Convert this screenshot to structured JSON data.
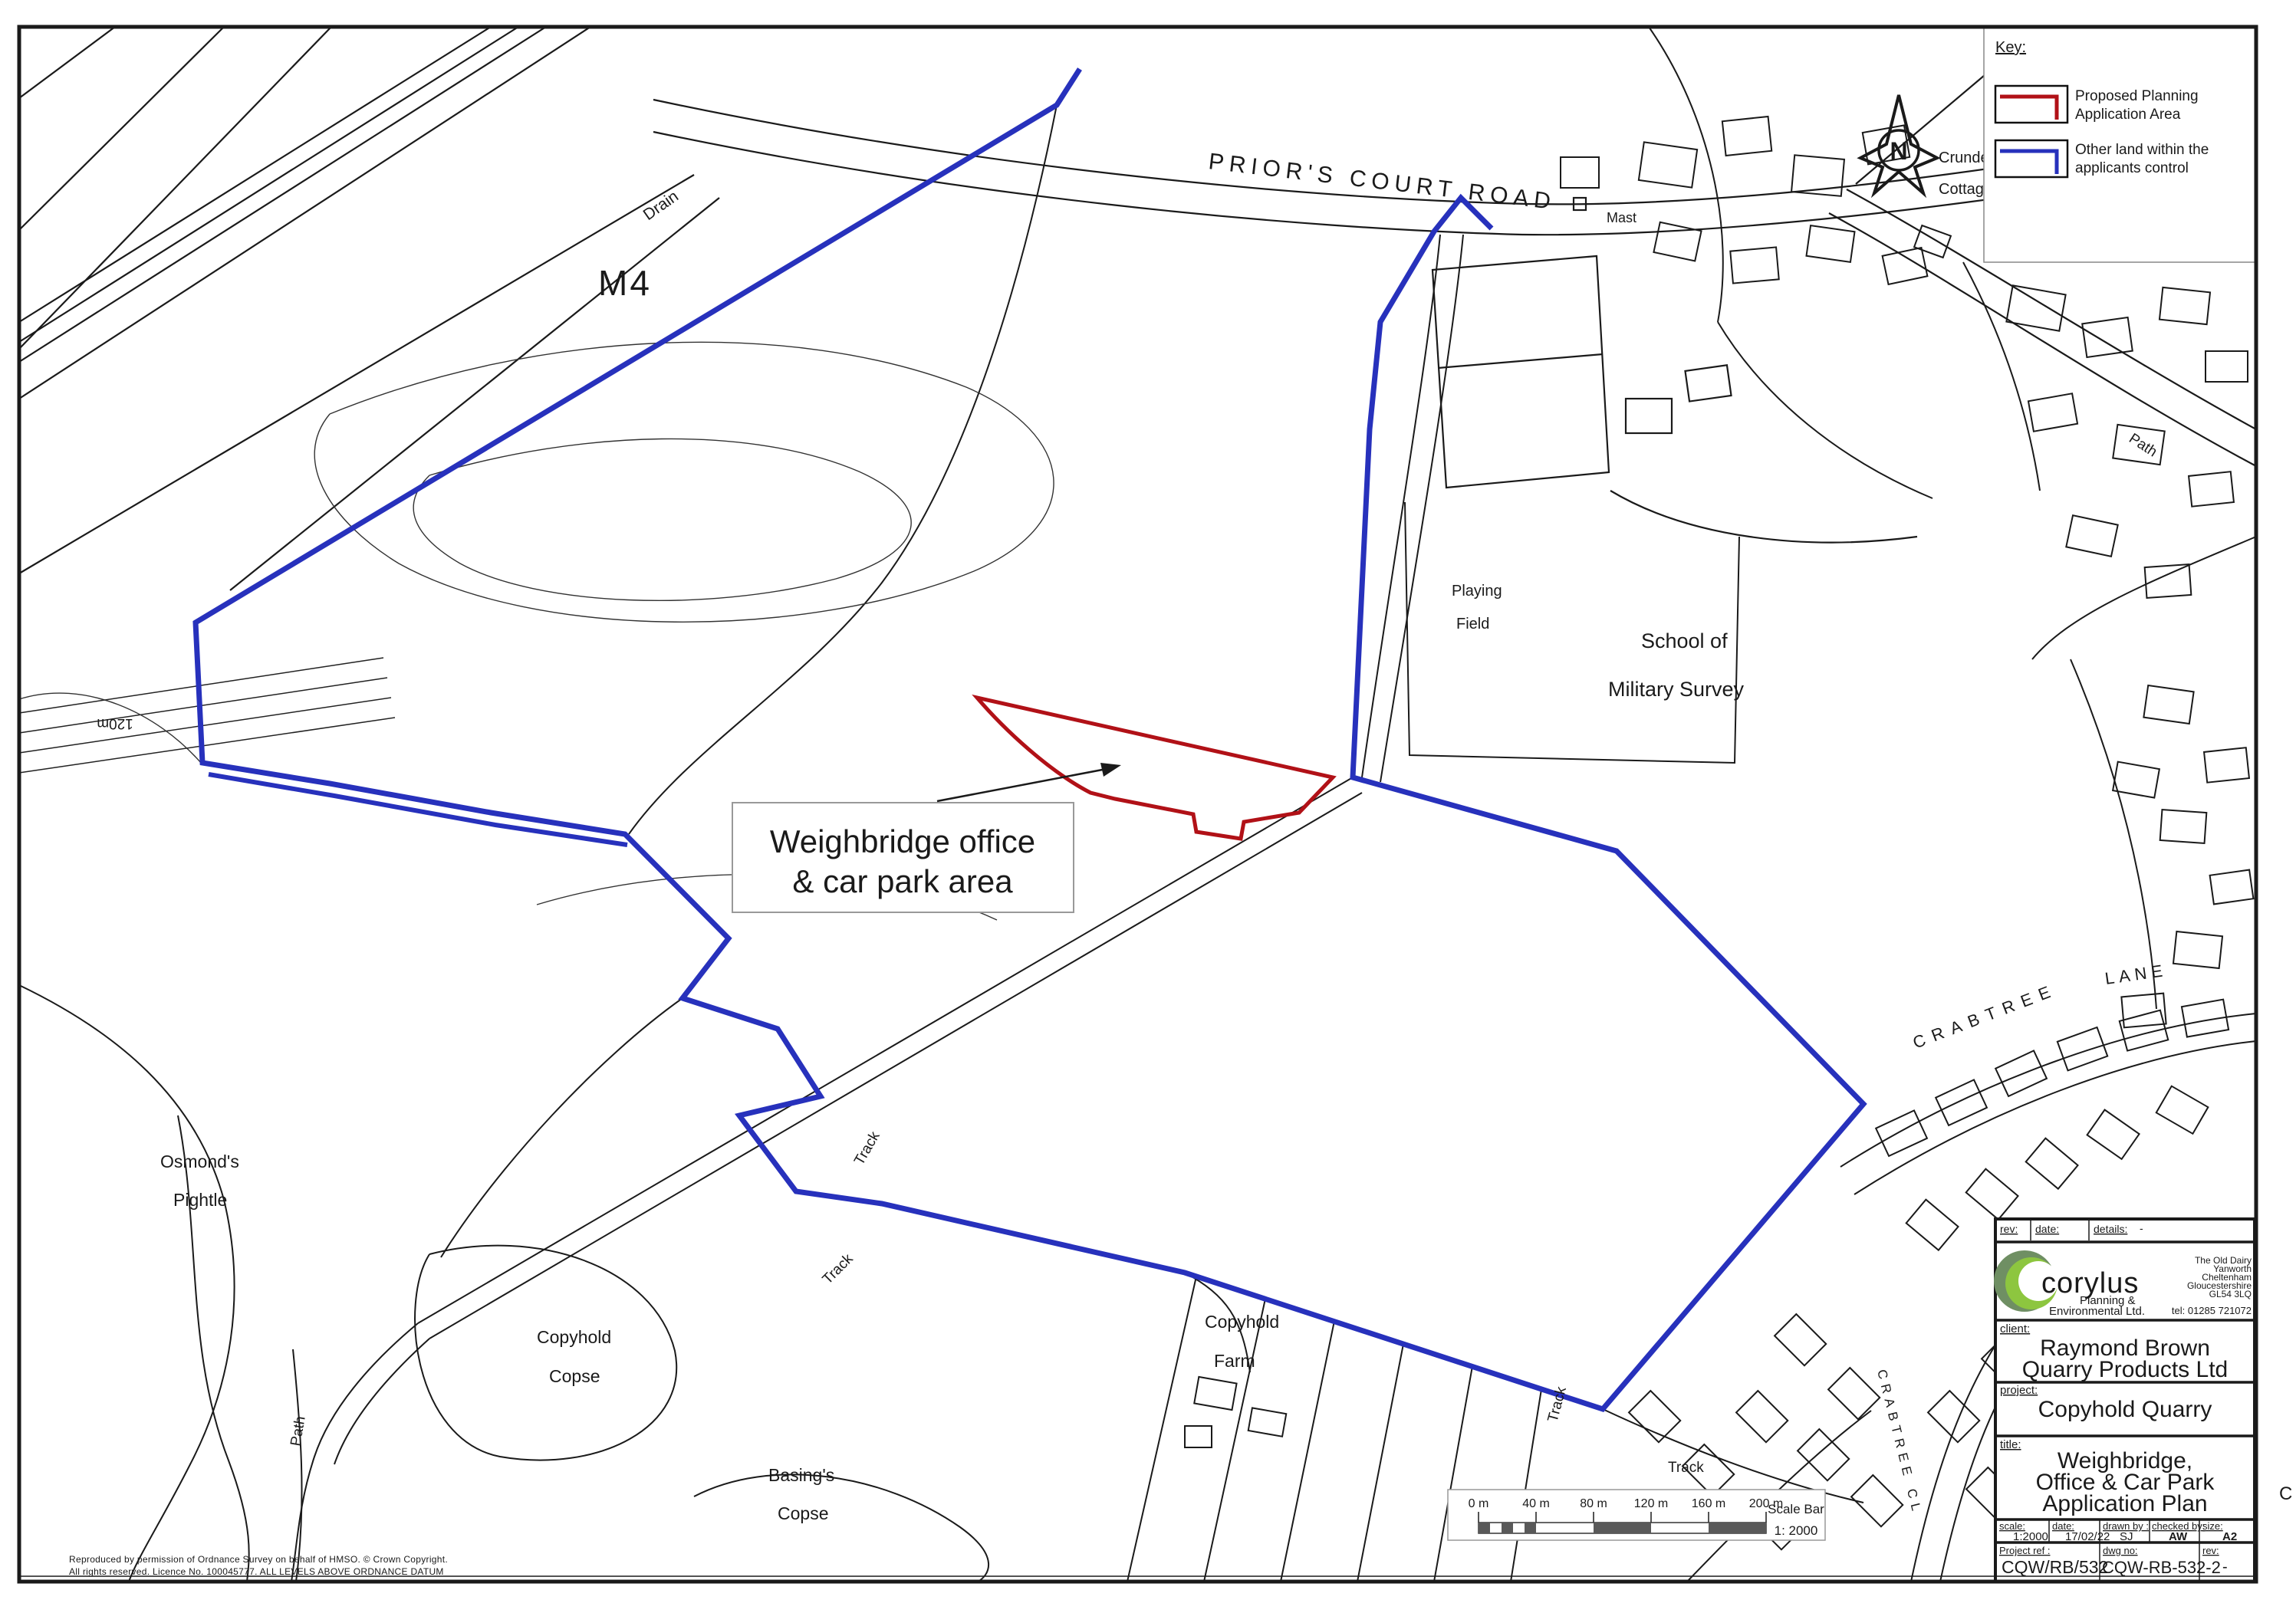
{
  "colors": {
    "application_red": "#B11117",
    "control_blue": "#2731BC",
    "bar_dark": "#595959",
    "line_black": "#1a1a1a"
  },
  "map_labels": {
    "m4": "M4",
    "priors_court_road": "PRIOR'S COURT ROAD",
    "drain": "Drain",
    "mast": "Mast",
    "crundel": "Crundel",
    "cottage": "Cottage",
    "path_ne": "Path",
    "playing": "Playing",
    "field": "Field",
    "school_of": "School of",
    "military_survey": "Military Survey",
    "crabtree": "CRABTREE",
    "lane": "LANE",
    "crabtree_cl": "CRABTREE CL",
    "cl": "CL",
    "osmonds": "Osmond's",
    "pightle": "Pightle",
    "copyhold_w": "Copyhold",
    "copse_w": "Copse",
    "basings": "Basing's",
    "copse_s": "Copse",
    "copyhold_farm": "Copyhold",
    "farm": "Farm",
    "path_sw": "Path",
    "track_1": "Track",
    "track_2": "Track",
    "track_3": "Track",
    "track_4": "Track",
    "contour_120m": "120m"
  },
  "annotation": {
    "line1": "Weighbridge office",
    "line2": "& car park area"
  },
  "key": {
    "heading": "Key:",
    "item1": {
      "line1": "Proposed Planning",
      "line2": "Application Area"
    },
    "item2": {
      "line1": "Other land within the",
      "line2": "applicants control"
    }
  },
  "compass": {
    "letter": "N"
  },
  "scalebar": {
    "ticks": [
      "0 m",
      "40 m",
      "80 m",
      "120 m",
      "160 m",
      "200 m"
    ],
    "title": "Scale Bar",
    "ratio": "1:  2000"
  },
  "copyright": {
    "line1": "Reproduced by permission of Ordnance Survey on behalf of HMSO. © Crown Copyright.",
    "line2": "All rights reserved.  Licence No. 100045777. ALL LEVELS ABOVE ORDNANCE DATUM"
  },
  "titleblock": {
    "header": {
      "rev": "rev:",
      "date": "date:",
      "details": "details:",
      "details_value": "-"
    },
    "firm": {
      "name": "corylus",
      "tagline1": "Planning &",
      "tagline2": "Environmental Ltd.",
      "address": [
        "The Old Dairy",
        "Yanworth",
        "Cheltenham",
        "Gloucestershire",
        "GL54 3LQ"
      ],
      "tel": "tel: 01285 721072"
    },
    "client_label": "client:",
    "client_line1": "Raymond Brown",
    "client_line2": "Quarry Products Ltd",
    "project_label": "project:",
    "project": "Copyhold Quarry",
    "title_label": "title:",
    "title_line1": "Weighbridge,",
    "title_line2": "Office & Car Park",
    "title_line3": "Application Plan",
    "fields": {
      "scale_label": "scale:",
      "scale": "1:2000",
      "date_label": "date:",
      "date": "17/02/22",
      "drawn_label": "drawn by :",
      "drawn": "SJ",
      "checked_label": "checked by:",
      "checked": "AW",
      "size_label": "size:",
      "size": "A2"
    },
    "refs": {
      "project_ref_label": "Project ref :",
      "project_ref": "CQW/RB/532",
      "dwg_label": "dwg no:",
      "dwg_no": "CQW-RB-532-2",
      "rev_label": "rev:",
      "rev_value": "-"
    }
  },
  "margin_mark": "C"
}
